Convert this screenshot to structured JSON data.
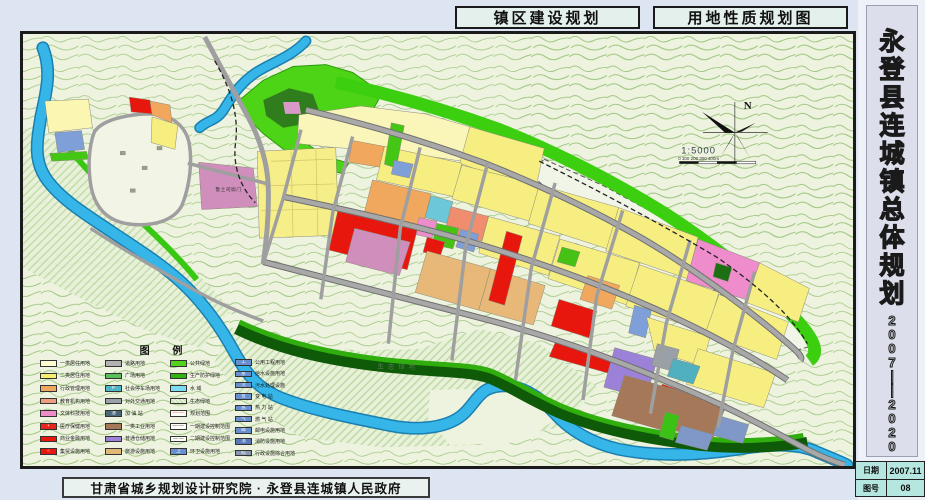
{
  "header": {
    "tab_left": "镇区建设规划",
    "tab_right": "用地性质规划图"
  },
  "sidebar": {
    "title": "永登县连城镇总体规划",
    "years": "2007——2020",
    "info_rows": [
      {
        "label": "日期",
        "value": "2007.11"
      },
      {
        "label": "图号",
        "value": "08"
      }
    ]
  },
  "footer": {
    "credit": "甘肃省城乡规划设计研究院 · 永登县连城镇人民政府"
  },
  "map": {
    "north_label": "N",
    "scale_text": "1:5000",
    "scale_bar_labels": "0    100    200    300   400m",
    "labels": [
      {
        "text": "鲁土司衙门"
      },
      {
        "text": "生态绿地"
      }
    ],
    "colors": {
      "residential_yellow": "#f6ee80",
      "commercial_red": "#e8170e",
      "education_orange": "#f0a85e",
      "culture_pink": "#ee8ccc",
      "heritage_purple": "#cf8ebc",
      "industry_brown": "#a5785a",
      "warehouse_purple": "#9b82d8",
      "municipal_blue": "#7f9fd8",
      "green_space": "#3ccf10",
      "water_blue": "#35b5e8",
      "road_gray": "#9f9f9f"
    },
    "legend": {
      "title": "图    例",
      "columns": [
        [
          {
            "label": "一类居住用地",
            "color": "#fdfbd0",
            "type": "fill"
          },
          {
            "label": "二类居住用地",
            "color": "#f6ee6e",
            "type": "fill"
          },
          {
            "label": "行政管理用地",
            "color": "#f2a85c",
            "type": "fill"
          },
          {
            "label": "教育机构用地",
            "color": "#ef9d7e",
            "type": "fill"
          },
          {
            "label": "文体科技用地",
            "color": "#ee8cc8",
            "type": "fill"
          },
          {
            "label": "医疗保健用地",
            "color": "#e8251c",
            "type": "icon",
            "glyph": "+"
          },
          {
            "label": "商业金融用地",
            "color": "#e8170e",
            "type": "fill"
          },
          {
            "label": "集贸设施用地",
            "color": "#e8170e",
            "type": "icon",
            "glyph": "☆"
          }
        ],
        [
          {
            "label": "道路用地",
            "color": "#b2b2b2",
            "type": "fill"
          },
          {
            "label": "广场用地",
            "color": "#5abf5a",
            "type": "fill"
          },
          {
            "label": "社会停车场用地",
            "color": "#4fb6c6",
            "type": "icon",
            "glyph": "P"
          },
          {
            "label": "对外交通用地",
            "color": "#98a0a8",
            "type": "fill"
          },
          {
            "label": "加 油 站",
            "color": "#4a6878",
            "type": "icon",
            "glyph": "油"
          },
          {
            "label": "一类工业用地",
            "color": "#a5785a",
            "type": "fill"
          },
          {
            "label": "普通仓储用地",
            "color": "#9b82d8",
            "type": "fill"
          },
          {
            "label": "旅游设施用地",
            "color": "#e0b878",
            "type": "fill"
          }
        ],
        [
          {
            "label": "公共绿地",
            "color": "#52d41a",
            "type": "fill"
          },
          {
            "label": "生产防护绿地",
            "color": "#30b412",
            "type": "fill"
          },
          {
            "label": "水    域",
            "color": "#7adcf0",
            "type": "fill"
          },
          {
            "label": "生态绿地",
            "color": "#ddeee0",
            "type": "hatch"
          },
          {
            "label": "规划范围",
            "color": "#e02020",
            "type": "line-red-dashdot"
          },
          {
            "label": "一期建设控制范围",
            "color": "#222222",
            "type": "line-dashdot"
          },
          {
            "label": "二期建设控制范围",
            "color": "#222222",
            "type": "line-dash"
          },
          {
            "label": "环卫设施用地",
            "color": "#6890d0",
            "type": "icon",
            "glyph": "卫"
          }
        ],
        [
          {
            "label": "公用工程用地",
            "color": "#6890d0",
            "type": "icon",
            "glyph": "工"
          },
          {
            "label": "给水设施用地",
            "color": "#6890d0",
            "type": "icon",
            "glyph": "水"
          },
          {
            "label": "污水处理设施",
            "color": "#6890d0",
            "type": "icon",
            "glyph": "污"
          },
          {
            "label": "变 电 站",
            "color": "#6890d0",
            "type": "icon",
            "glyph": "变"
          },
          {
            "label": "热 力 站",
            "color": "#6890d0",
            "type": "icon",
            "glyph": "热"
          },
          {
            "label": "燃 气 站",
            "color": "#6890d0",
            "type": "icon",
            "glyph": "气"
          },
          {
            "label": "邮电设施用地",
            "color": "#6890d0",
            "type": "icon",
            "glyph": "邮"
          },
          {
            "label": "消防设施用地",
            "color": "#5878b8",
            "type": "icon",
            "glyph": "消"
          },
          {
            "label": "行政设施综合用地",
            "color": "#8898b0",
            "type": "icon",
            "glyph": "综"
          }
        ]
      ]
    }
  }
}
